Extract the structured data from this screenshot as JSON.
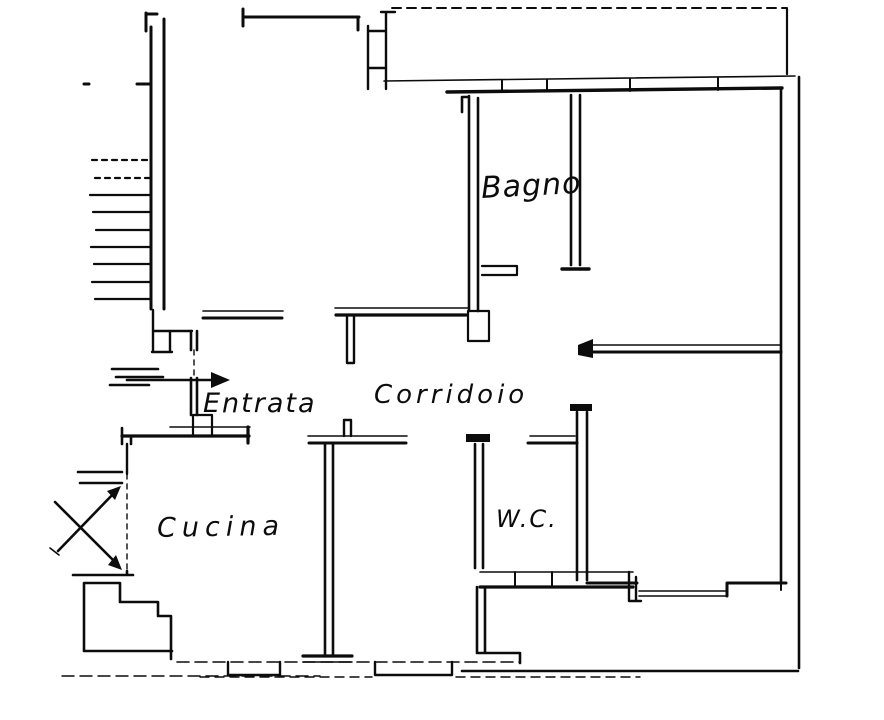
{
  "page": {
    "paper_color": "#ffffff",
    "ink_color": "#0c0c0c"
  },
  "floor_plan": {
    "labels": {
      "bathroom": "Bagno",
      "entrance": "Entrata",
      "corridor": "Corridoio",
      "kitchen": "Cucina",
      "wc": "W.C."
    },
    "marks": {
      "entrance_arrow": "right-arrow",
      "entrance_door_marks": "triple-dash",
      "balcony_cross": "x-cross-with-arrowheads",
      "stair_tread_count": 9
    }
  }
}
